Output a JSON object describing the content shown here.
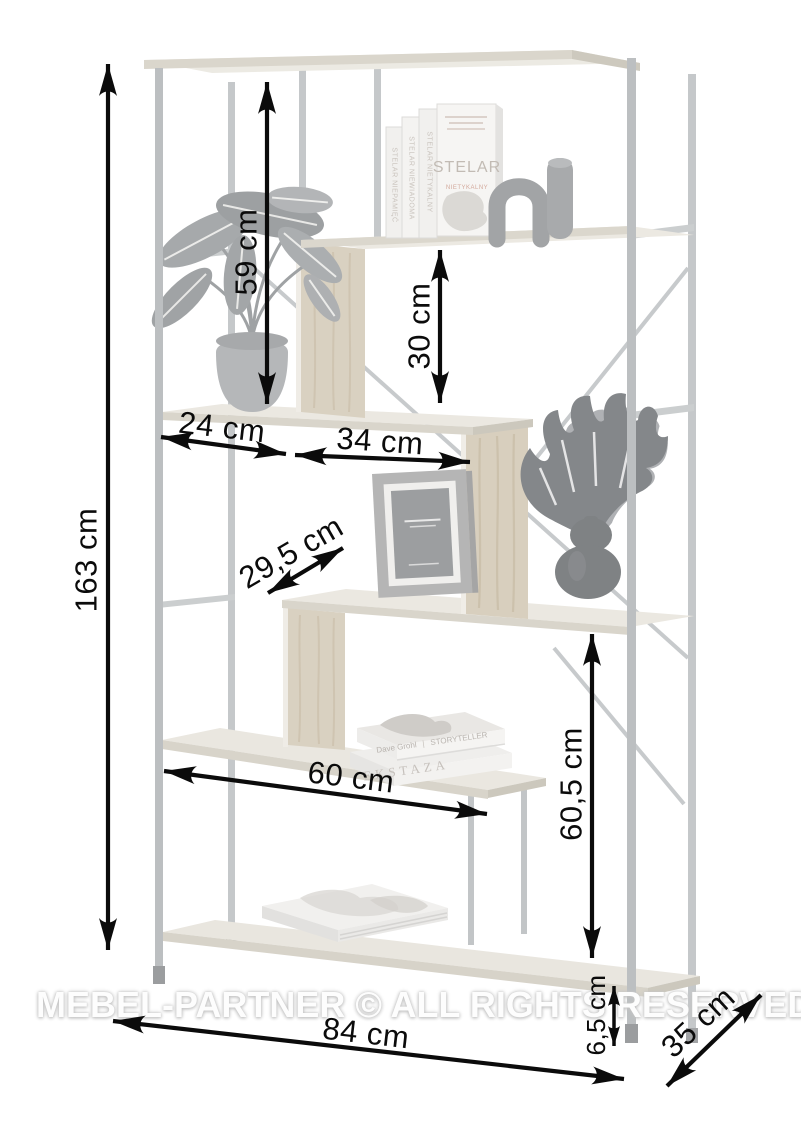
{
  "watermark": {
    "text": "MEBEL-PARTNER © ALL RIGHTS RESERVED"
  },
  "dimensions": {
    "total_height": {
      "label": "163 cm"
    },
    "upper_clearance": {
      "label": "59 cm"
    },
    "compartment_height": {
      "label": "30 cm"
    },
    "left_compartment_width": {
      "label": "24 cm"
    },
    "middle_compartment_width": {
      "label": "34 cm"
    },
    "shelf_depth_diagonal": {
      "label": "29,5 cm"
    },
    "lower_shelf_width": {
      "label": "60 cm"
    },
    "lower_clearance": {
      "label": "60,5 cm"
    },
    "base_clearance": {
      "label": "6,5 cm"
    },
    "total_width": {
      "label": "84 cm"
    },
    "total_depth": {
      "label": "35 cm"
    }
  },
  "decor": {
    "upright_books": {
      "spine_1": "STELAR NIEPAMIĘĆ",
      "spine_2": "STELAR NIEWIADOMA",
      "spine_3": "STELAR NIETYKALNY",
      "cover_title": "STELAR",
      "cover_subtitle": "NIETYKALNY"
    },
    "flat_books": {
      "author": "Dave Grohl",
      "separator": "|",
      "title": "STORYTELLER",
      "second_title": "EKSTAZA"
    }
  },
  "colors": {
    "dimension_ink": "#0b0b0b",
    "metal_frame": "#c0c3c5",
    "shelf_board": "#ebe8e1",
    "wood_panel": "#d9d1c1",
    "watermark": "#fdfdfd",
    "background": "#ffffff"
  }
}
